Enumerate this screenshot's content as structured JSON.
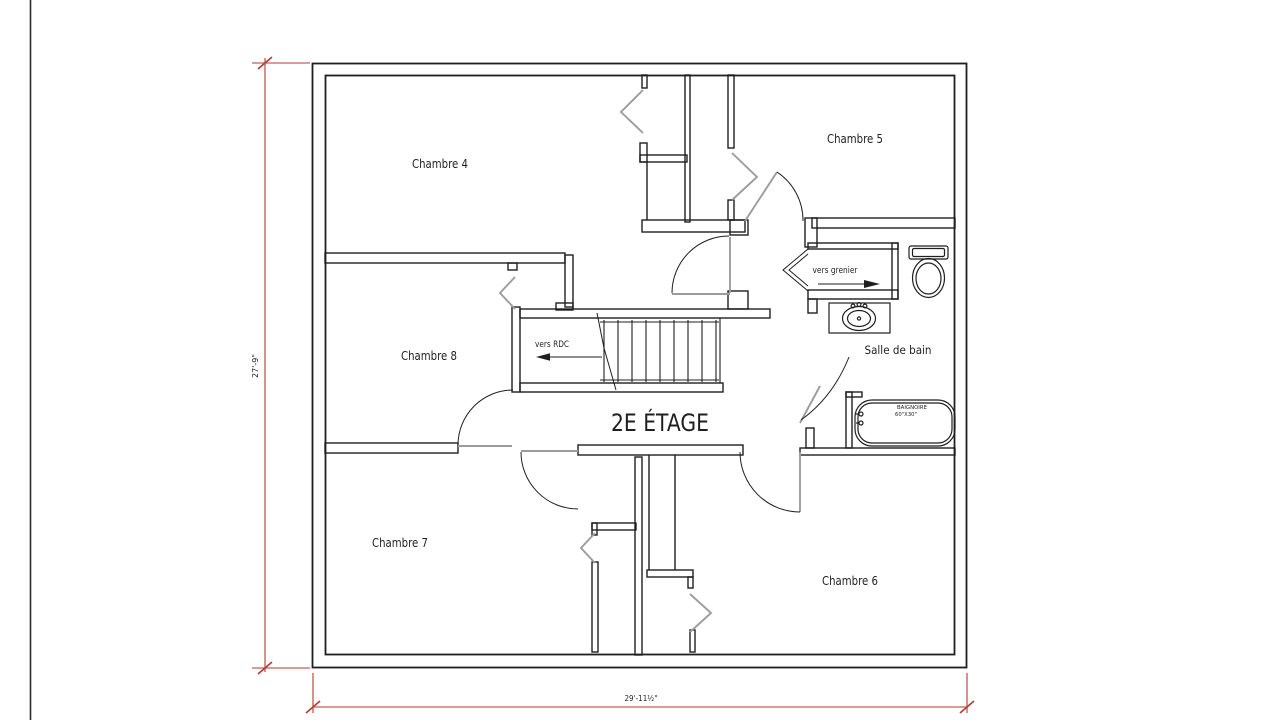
{
  "window": {
    "width": 1280,
    "height": 720
  },
  "drawing": {
    "title": "2E ÉTAGE",
    "rooms": [
      {
        "label": "Chambre 4"
      },
      {
        "label": "Chambre 5"
      },
      {
        "label": "Chambre 8"
      },
      {
        "label": "Chambre 7"
      },
      {
        "label": "Chambre 6"
      },
      {
        "label": "Salle de bain"
      }
    ],
    "annotations": {
      "to_ground_floor": "vers RDC",
      "to_attic": "vers grenier"
    },
    "fixtures": {
      "bathtub": {
        "line1": "BAIGNOIRE",
        "line2": "60\"X30\""
      }
    },
    "dimensions": {
      "vertical": "27'-9\"",
      "horizontal": "29'-11½\""
    },
    "colors": {
      "wall": "#1f1f1f",
      "door": "#9c9c9c",
      "dim": "#b23b2e",
      "text": "#1f1f1f"
    }
  }
}
